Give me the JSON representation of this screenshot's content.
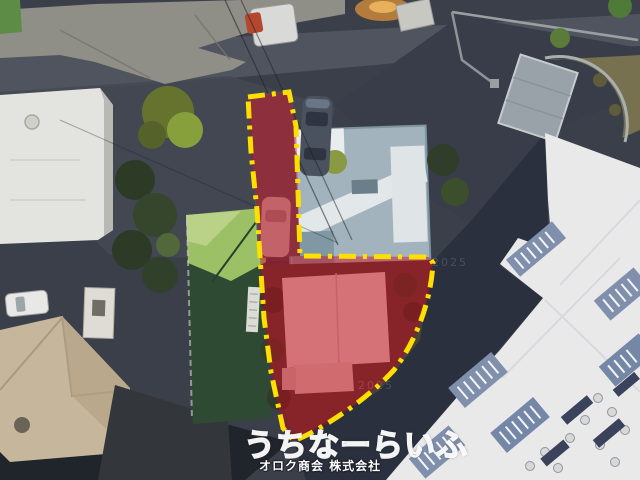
{
  "watermark": {
    "brand": "うちなーらいふ",
    "company": "オロク商会 株式会社"
  },
  "imagery": {
    "faint_year": "2025"
  },
  "colors": {
    "parcel_fill": "#d40016",
    "parcel_outline": "#ffdf00"
  }
}
